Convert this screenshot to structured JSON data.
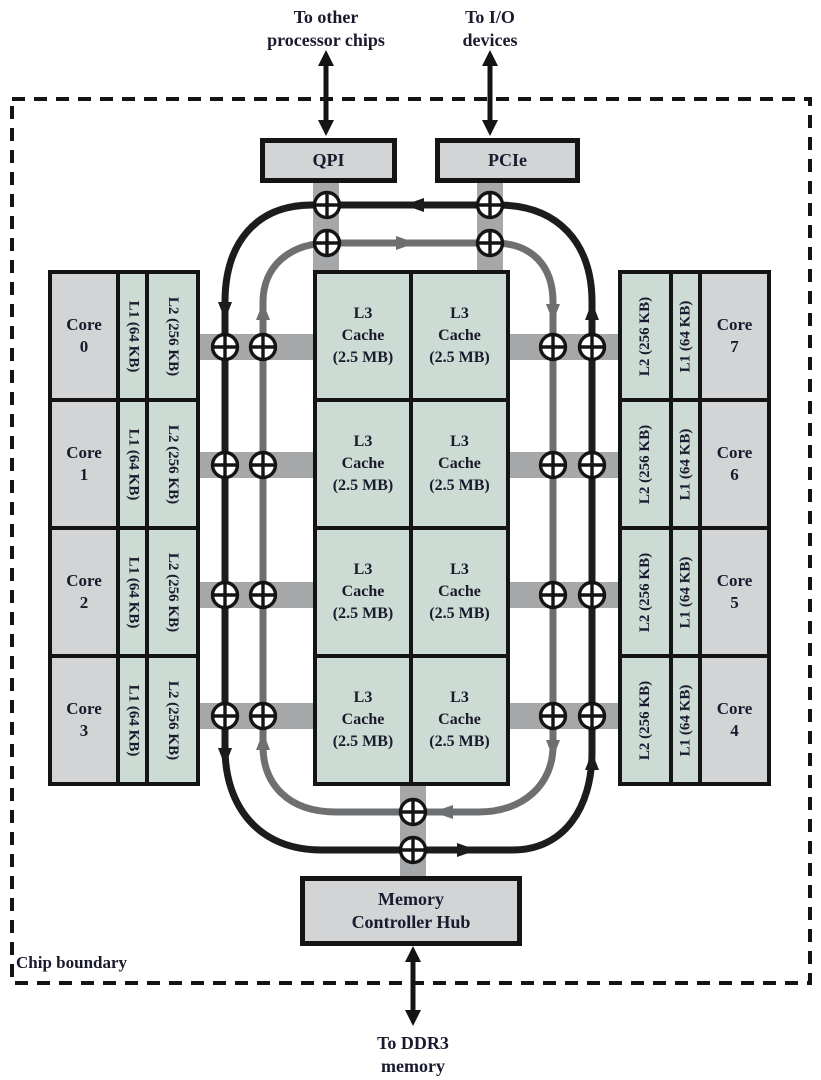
{
  "labels": {
    "to_other": "To other\nprocessor chips",
    "to_io": "To I/O\ndevices",
    "to_ddr3": "To DDR3\nmemory",
    "chip_boundary": "Chip boundary"
  },
  "interconnect": {
    "qpi": "QPI",
    "pcie": "PCIe",
    "mch": "Memory\nController Hub"
  },
  "left_cores": [
    {
      "core": "Core\n0",
      "l1": "L1 (64 KB)",
      "l2": "L2 (256 KB)"
    },
    {
      "core": "Core\n1",
      "l1": "L1 (64 KB)",
      "l2": "L2 (256 KB)"
    },
    {
      "core": "Core\n2",
      "l1": "L1 (64 KB)",
      "l2": "L2 (256 KB)"
    },
    {
      "core": "Core\n3",
      "l1": "L1 (64 KB)",
      "l2": "L2 (256 KB)"
    }
  ],
  "right_cores": [
    {
      "core": "Core\n7",
      "l1": "L1 (64 KB)",
      "l2": "L2 (256 KB)"
    },
    {
      "core": "Core\n6",
      "l1": "L1 (64 KB)",
      "l2": "L2 (256 KB)"
    },
    {
      "core": "Core\n5",
      "l1": "L1 (64 KB)",
      "l2": "L2 (256 KB)"
    },
    {
      "core": "Core\n4",
      "l1": "L1 (64 KB)",
      "l2": "L2 (256 KB)"
    }
  ],
  "l3_cells": [
    "L3\nCache\n(2.5 MB)",
    "L3\nCache\n(2.5 MB)",
    "L3\nCache\n(2.5 MB)",
    "L3\nCache\n(2.5 MB)",
    "L3\nCache\n(2.5 MB)",
    "L3\nCache\n(2.5 MB)",
    "L3\nCache\n(2.5 MB)",
    "L3\nCache\n(2.5 MB)"
  ],
  "icons": {
    "ring_stop": "circled-plus-ring-stop",
    "double_arrow": "double-headed-arrow"
  },
  "colors": {
    "box_gray": "#d3d4d6",
    "cache_teal": "#ccdbd3",
    "bus_gray": "#a6a7a9",
    "ring_black": "#1c1c1e",
    "ring_gray": "#6e6f71",
    "text": "#1a1a2e"
  }
}
